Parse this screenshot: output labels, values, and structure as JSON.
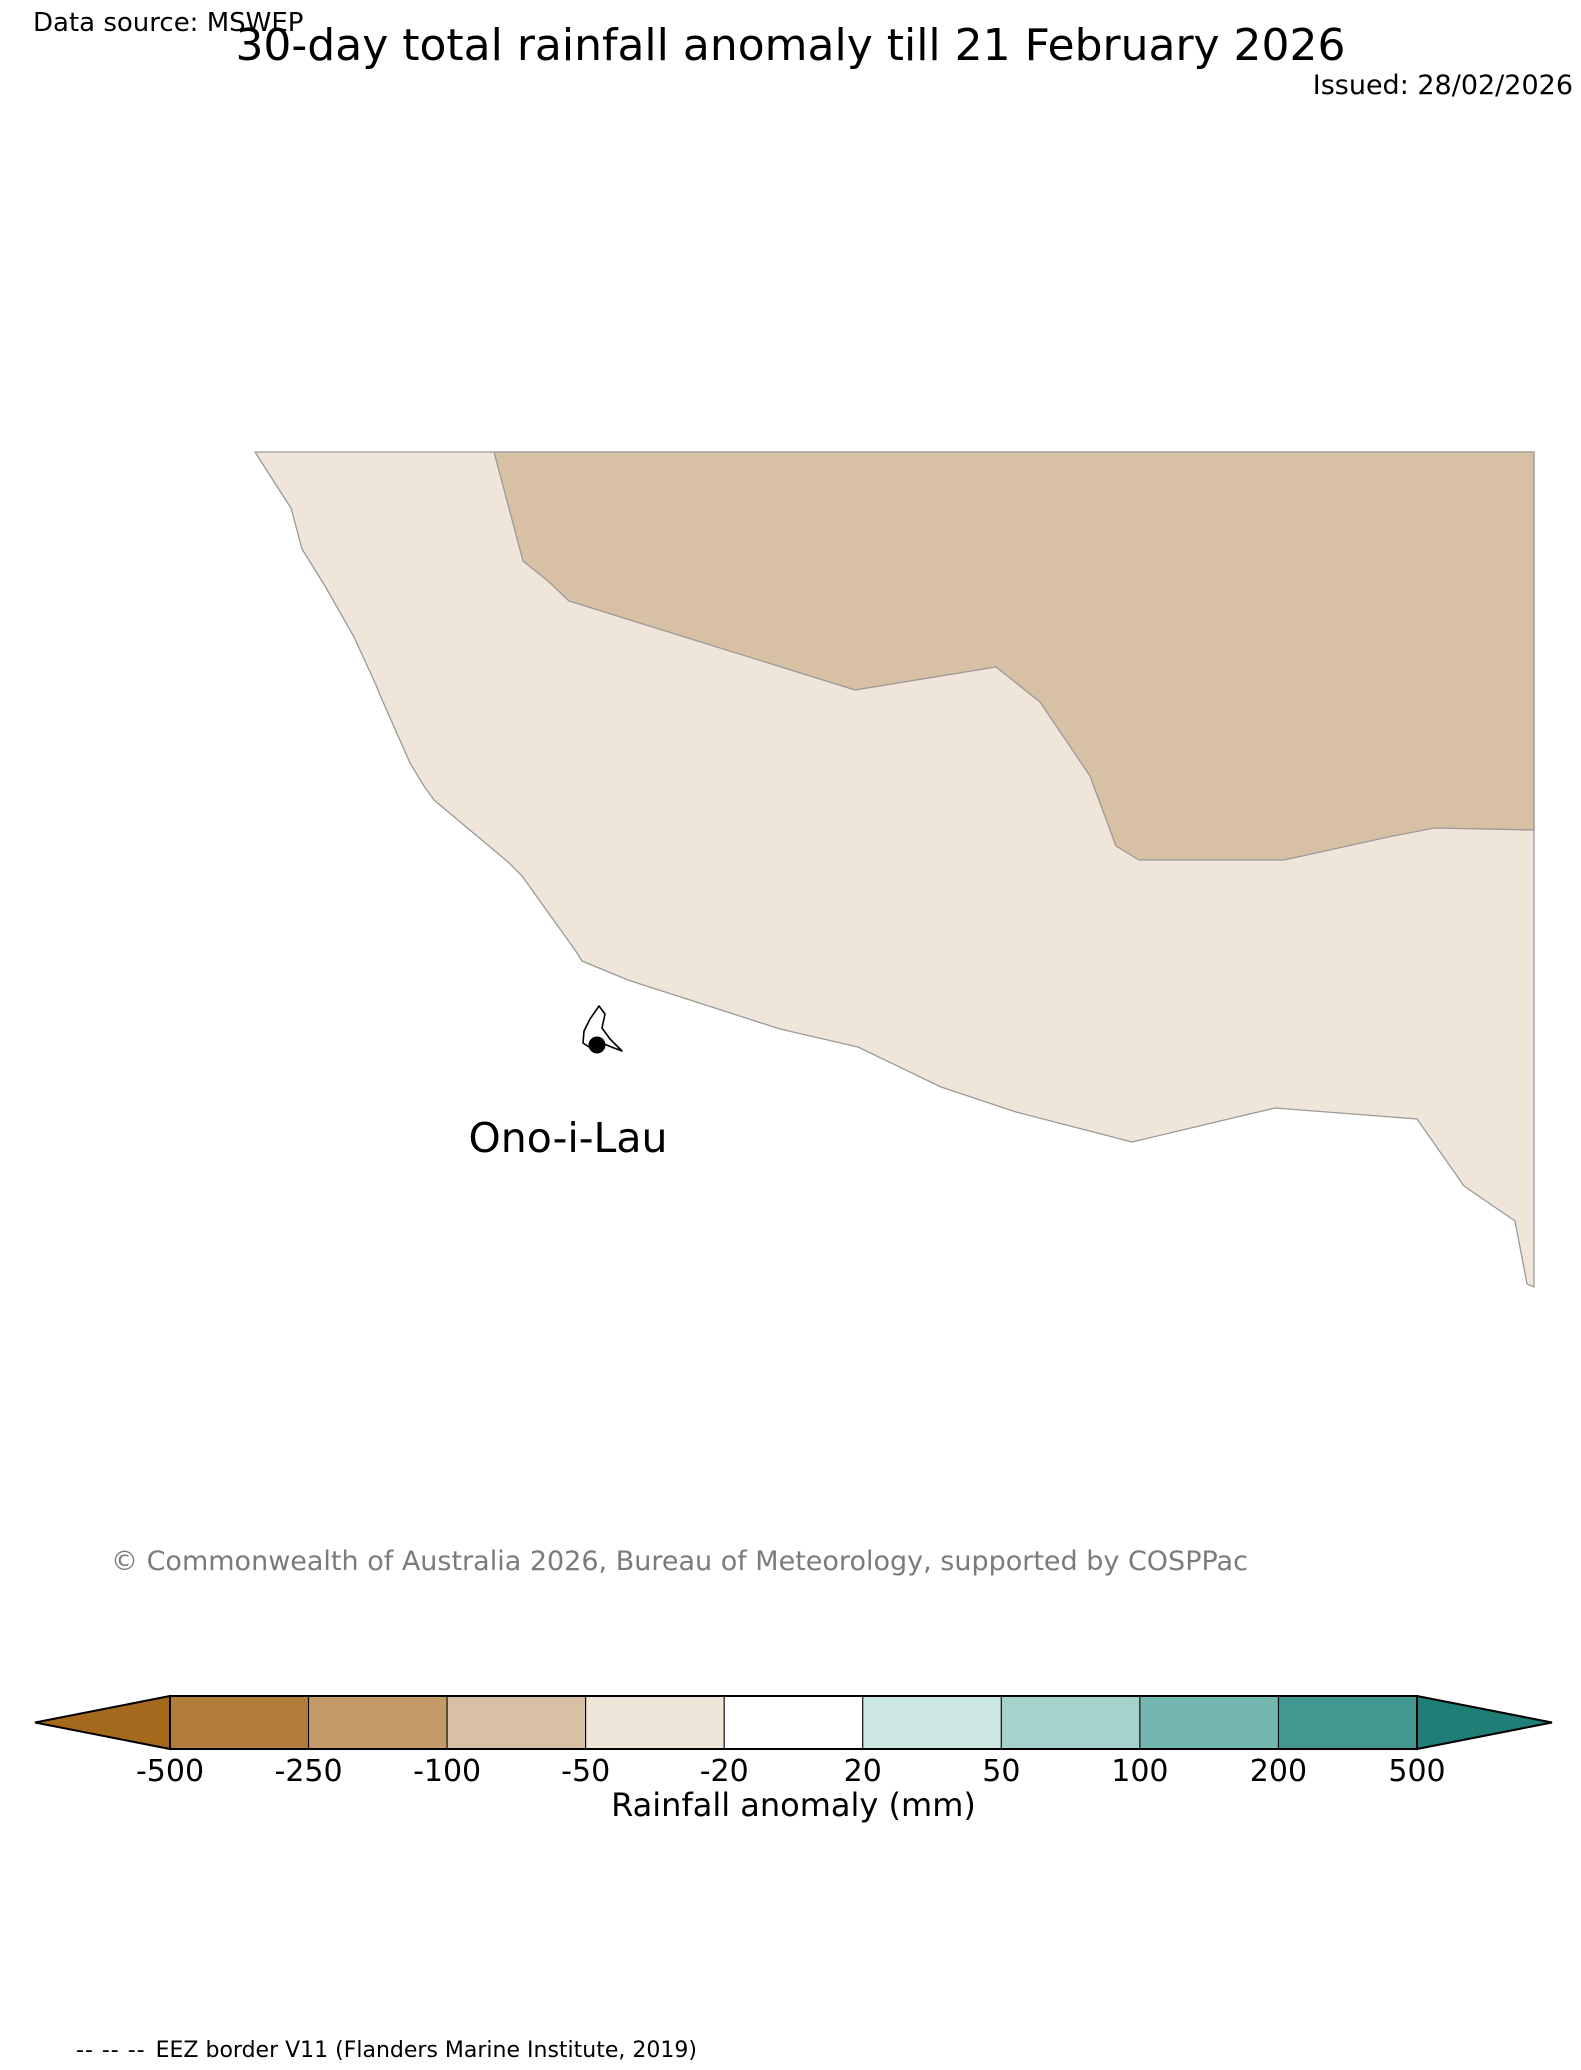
{
  "header": {
    "data_source": "Data source: MSWEP",
    "title": "30-day total rainfall anomaly till 21 February 2026",
    "issued": "Issued: 28/02/2026"
  },
  "map": {
    "place_label": "Ono-i-Lau",
    "outline_color": "#9a9a9a",
    "marker": {
      "cx": 597,
      "cy": 1045,
      "r": 8.5,
      "color": "#000000"
    },
    "island_path": "M599,1006 L590,1019 L584,1031 L583,1043 L589,1047 L596,1041 L604,1044 L614,1048 L622,1051 L610,1039 L602,1028 L605,1014 Z",
    "regions": [
      {
        "id": "band-minus50-minus20",
        "value_range": "-50 to -20 mm",
        "color": "#f0e5d9",
        "path": "M255,452 L1534,452 L1534,1287 L1527,1284 L1515,1221 L1464,1186 L1417,1119 L1275,1108 L1132,1142 L1016,1112 L941,1087 L858,1047 L780,1029 L628,980 L582,961 L575,950 L522,876 L508,862 L434,800 L424,786 L410,763 L380,695 L376,685 L354,637 L325,586 L302,549 L291,508 L278,488 Z"
      },
      {
        "id": "band-minus100-minus50",
        "value_range": "-100 to -50 mm",
        "color": "#d8c0a5",
        "path": "M494,452 L523,561 L548,581 L569,601 L855,690 L996,667 L1040,702 L1090,776 L1116,846 L1139,860 L1284,860 L1393,836 L1435,828 L1534,830 L1534,452 Z"
      }
    ]
  },
  "footer": {
    "copyright": "© Commonwealth of Australia 2026, Bureau of Meteorology, supported by COSPPac"
  },
  "colorbar": {
    "label": "Rainfall anomaly (mm)",
    "ticks": [
      "-500",
      "-250",
      "-100",
      "-50",
      "-20",
      "20",
      "50",
      "100",
      "200",
      "500"
    ],
    "segment_colors": [
      "#b27c3a",
      "#c49a69",
      "#d8c0a5",
      "#f0e5d9",
      "#ffffff",
      "#cde7e2",
      "#a5d2cb",
      "#74b6b0",
      "#42988f"
    ],
    "left_arrow_color": "#a5691d",
    "right_arrow_color": "#1f7e75",
    "outline_color": "#000000",
    "geometry": {
      "x0": 170,
      "x1": 1417,
      "y0": 1696,
      "y1": 1749,
      "tip_left": 35,
      "tip_right": 1552
    }
  },
  "eez_legend": {
    "dashes": "-- -- --",
    "label": "EEZ border V11 (Flanders Marine Institute, 2019)"
  },
  "chart_data": {
    "type": "filled_contour_map",
    "title": "30-day total rainfall anomaly till 21 February 2026",
    "issued": "28/02/2026",
    "data_source": "MSWEP",
    "location_marked": "Ono-i-Lau",
    "colorbar_label": "Rainfall anomaly (mm)",
    "colorbar_levels_mm": [
      -500,
      -250,
      -100,
      -50,
      -20,
      20,
      50,
      100,
      200,
      500
    ],
    "bands_shown": [
      {
        "range_mm": "-100 to -50",
        "area": "north-east portion of the map"
      },
      {
        "range_mm": "-50 to -20",
        "area": "broad central band sweeping from north-west to south-east"
      },
      {
        "range_mm": "-20 to 20 (white)",
        "area": "south-west area containing the Ono-i-Lau marker"
      }
    ],
    "legend_position": "horizontal colorbar at bottom with pointed out-of-range arrows"
  }
}
